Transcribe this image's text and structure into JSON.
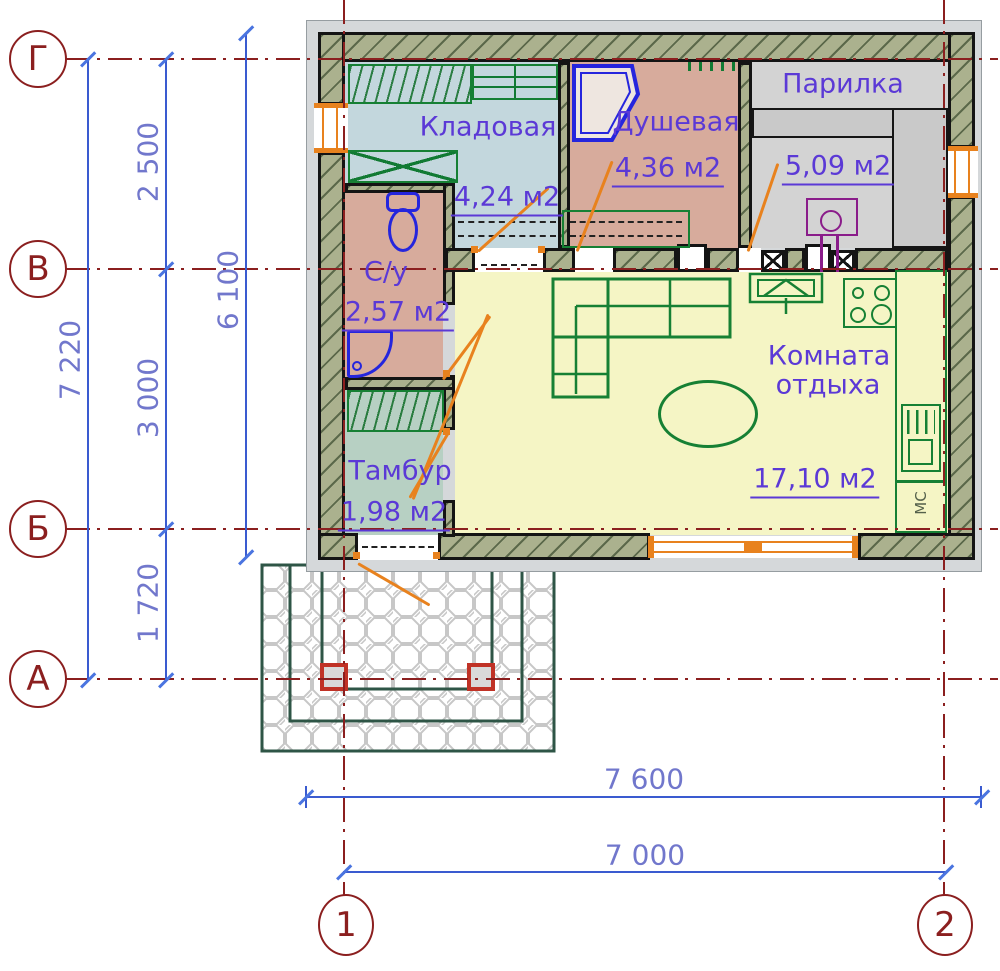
{
  "plan": {
    "title": "План бани",
    "rooms": [
      {
        "name": "Кладовая",
        "area": "4,24 м2"
      },
      {
        "name": "Душевая",
        "area": "4,36 м2"
      },
      {
        "name": "Парилка",
        "area": "5,09 м2"
      },
      {
        "name": "С/у",
        "area": "2,57 м2"
      },
      {
        "name": "Тамбур",
        "area": "1,98 м2"
      },
      {
        "name_line1": "Комната",
        "name_line2": "отдыха",
        "area": "17,10 м2"
      }
    ],
    "appliance_label": "МС",
    "axes": {
      "row_markers": [
        "Г",
        "В",
        "Б",
        "А"
      ],
      "col_markers": [
        "1",
        "2"
      ]
    },
    "dimensions": {
      "total_height": "7 220",
      "seg_top": "2 500",
      "seg_mid": "3 000",
      "seg_bottom": "1 720",
      "inner_height": "6 100",
      "total_width": "7 600",
      "axis_width": "7 000"
    },
    "colors": {
      "wall_hatch": "#abb18e",
      "storage_floor": "#c3d7dd",
      "shower_floor": "#d7ab9c",
      "steam_floor": "#d3d3d3",
      "wc_floor": "#d7ab9c",
      "vestibule_floor": "#b7d0c3",
      "lounge_floor": "#f5f5c5",
      "furniture": "#168034",
      "sanitary": "#2525dd",
      "dimension": "#3a5bd0",
      "axis": "#8b1f1f",
      "opening": "#e8821e",
      "stove": "#8a1c8a"
    }
  }
}
